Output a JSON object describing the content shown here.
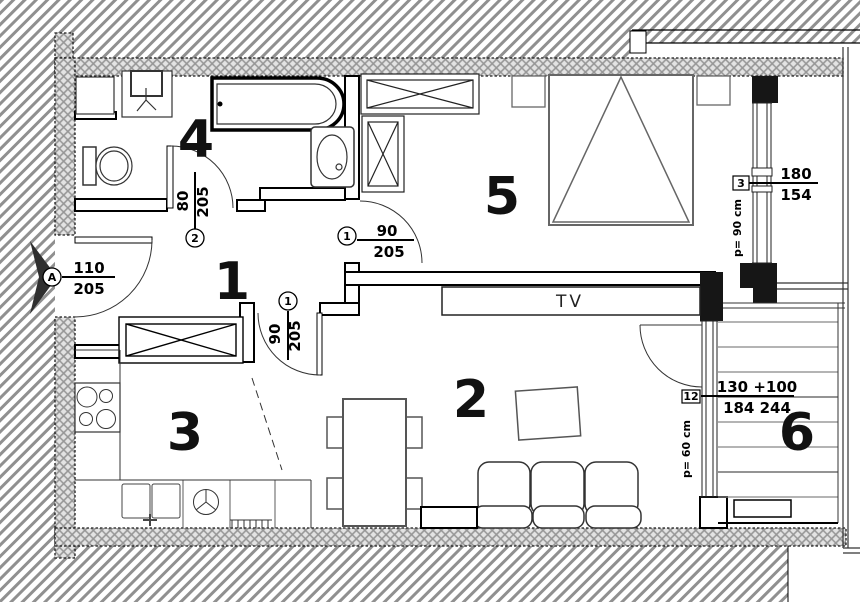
{
  "plan_title": "apartment floor plan",
  "rooms": {
    "hallway": {
      "number": "1"
    },
    "living": {
      "number": "2"
    },
    "kitchen": {
      "number": "3"
    },
    "bathroom": {
      "number": "4"
    },
    "bedroom": {
      "number": "5"
    },
    "balcony": {
      "number": "6"
    }
  },
  "furniture": {
    "tv": "TV"
  },
  "doors": {
    "entrance": {
      "tag": "A",
      "width": "110",
      "height": "205"
    },
    "bathroom": {
      "tag": "2",
      "width": "80",
      "height": "205"
    },
    "bedroom": {
      "tag": "1",
      "width": "90",
      "height": "205"
    },
    "living": {
      "tag": "1",
      "width": "90",
      "height": "205"
    }
  },
  "windows": {
    "bedroom": {
      "tag": "3",
      "width": "180",
      "height": "154",
      "parapet": "p= 90 cm"
    },
    "balcony": {
      "tag": "12",
      "width": "130 +100",
      "height": "184  244",
      "parapet": "p= 60 cm"
    }
  },
  "colors": {
    "outline": "#000000",
    "hatch": "#909090",
    "wall_fill": "#e3e3e3",
    "wall_grid": "#969696",
    "furniture_gray": "#666666",
    "arrow_dark": "#2f2f2f"
  }
}
